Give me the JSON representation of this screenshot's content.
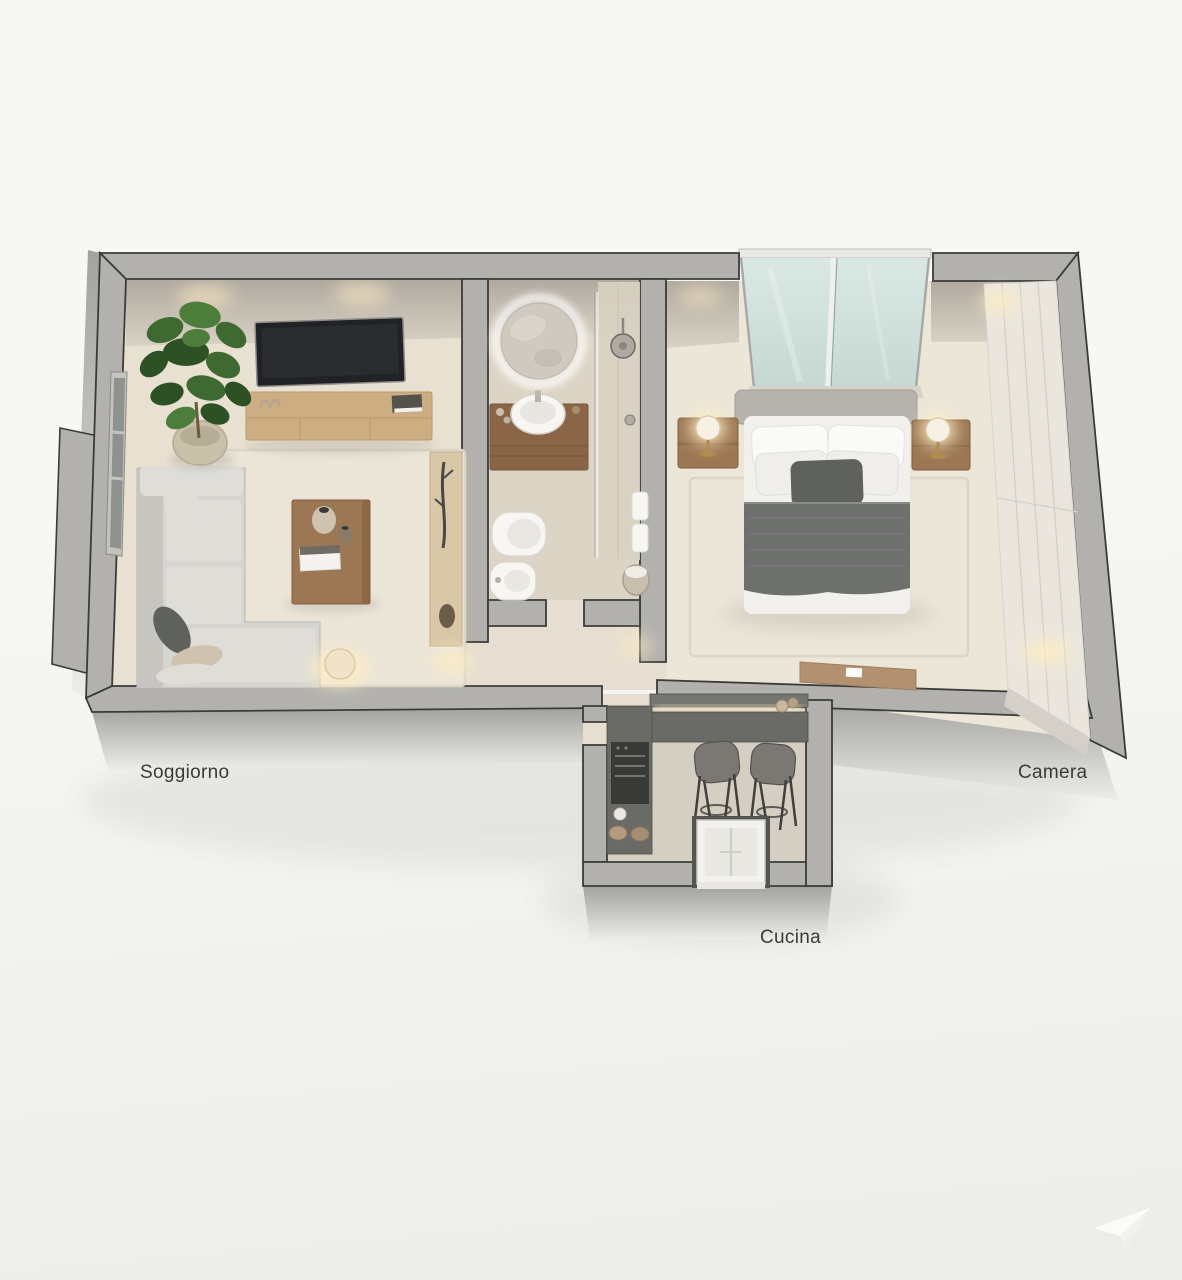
{
  "rooms": {
    "living": {
      "label": "Soggiorno"
    },
    "bedroom": {
      "label": "Camera"
    },
    "kitchen": {
      "label": "Cucina"
    }
  },
  "watermark": {
    "icon": "swoosh-logo-icon"
  },
  "colors": {
    "bg_1": "#f7f7f5",
    "bg_2": "#ececea",
    "wall_top": "#b2b1ad",
    "wall_face": "#a3a29e",
    "outline": "#3b3b39",
    "back_face_1": "#b0a99f",
    "back_face_2": "#d8d1c4",
    "floor_living": "#e8e0d1",
    "floor_bath": "#dcd4c5",
    "floor_bed": "#ece6d8",
    "floor_hall": "#e6ded0",
    "floor_kitchen": "#d5cfc3",
    "rug": "#ebe5d8",
    "rug_border": "#dcd5c6",
    "wood_light": "#ccae82",
    "wood_mid": "#9c7753",
    "wood_dark": "#8a6647",
    "wood_warm": "#b29170",
    "sofa": "#d7d5d0",
    "sofa_light": "#deddd8",
    "sofa_dark": "#c7c5c0",
    "pillow_dark": "#5e615e",
    "pillow_tan": "#cfc2ae",
    "bed_white": "#f1f0ed",
    "blanket": "#6e706e",
    "headboard": "#b6b2ac",
    "glass_1": "#dae8e4",
    "glass_2": "#c6d8d3",
    "glass_dark": "#8d928e",
    "counter": "#6a6a67",
    "counter_dark": "#393937",
    "stool": "#7b7874",
    "cream": "#eae6de",
    "green_1": "#3e6a31",
    "green_2": "#2d5124",
    "green_3": "#4c7d3b",
    "glow": "#ffedc2",
    "mirror": "#cfc9bf",
    "pot": "#c9c0aa",
    "white_fix": "#f7f6f3",
    "label": "#3a3a38"
  }
}
